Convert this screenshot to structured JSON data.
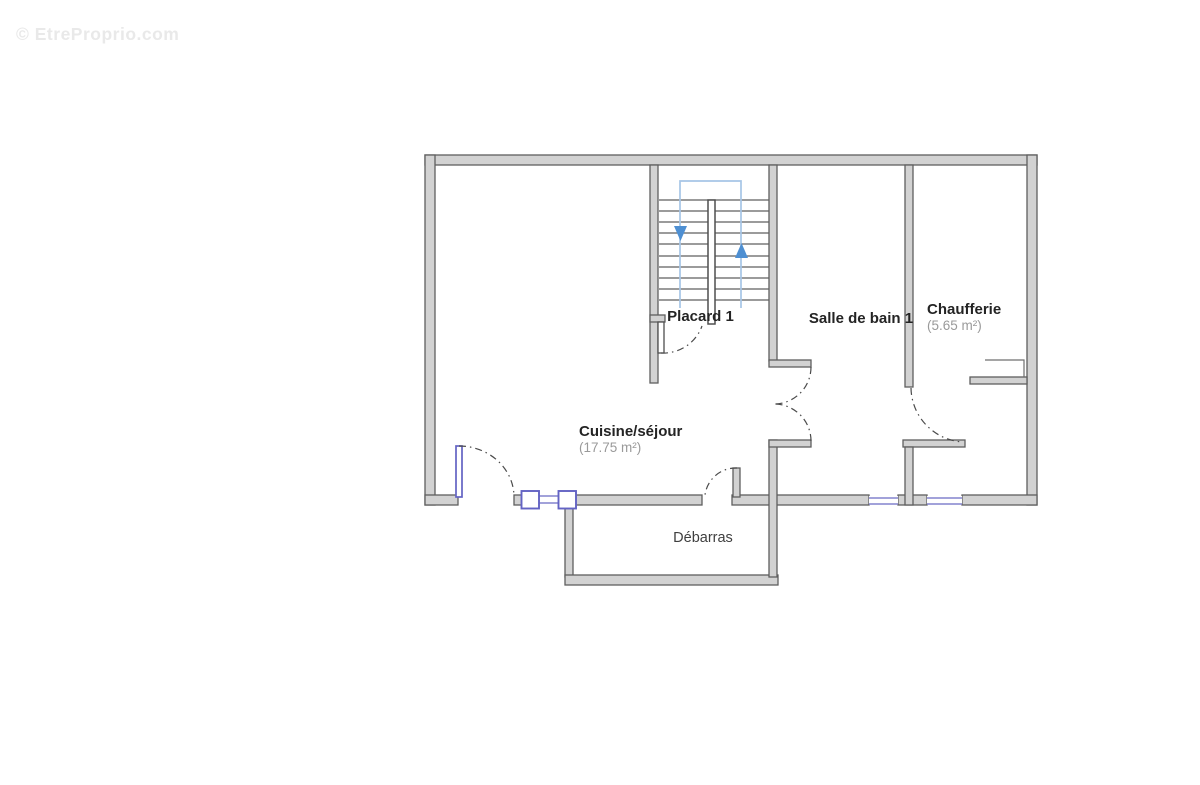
{
  "watermark": "© EtreProprio.com",
  "plan": {
    "rooms": [
      {
        "name": "Placard 1",
        "area": ""
      },
      {
        "name": "Salle de bain 1",
        "area": ""
      },
      {
        "name": "Chaufferie",
        "area": "(5.65 m²)"
      },
      {
        "name": "Cuisine/séjour",
        "area": "(17.75 m²)"
      },
      {
        "name": "Débarras",
        "area": ""
      }
    ],
    "stairs": {
      "down_icon": "down-arrow",
      "up_icon": "up-arrow"
    },
    "colors": {
      "wall_fill": "#d2d2d2",
      "wall_outline": "#5f5f5f",
      "window_door_blue": "#6363c4",
      "stair_guide_blue": "#a6c5e6",
      "stair_arrow_blue": "#4e8fd2",
      "room_name_text": "#242424",
      "room_area_text": "#9a9a9a",
      "plain_label_text": "#3f3f3f",
      "watermark_text": "#e9e9e9",
      "background": "#ffffff"
    }
  }
}
